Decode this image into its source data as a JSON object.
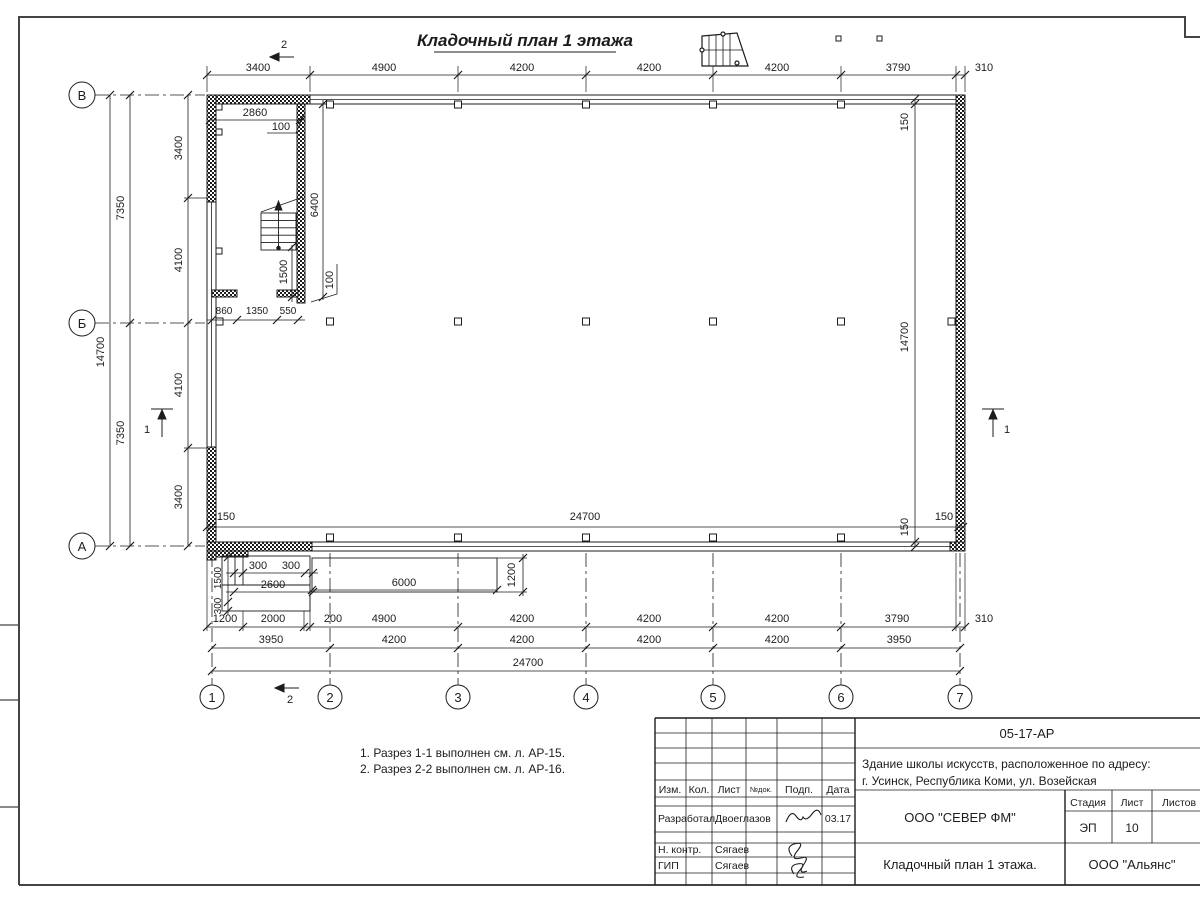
{
  "page_title": "Кладочный план 1 этажа",
  "plan": {
    "axis_letters": [
      "В",
      "Б",
      "А"
    ],
    "axis_numbers": [
      "1",
      "2",
      "3",
      "4",
      "5",
      "6",
      "7"
    ],
    "sections": {
      "one": "1",
      "two": "2"
    },
    "dims": {
      "top": [
        "3400",
        "4900",
        "4200",
        "4200",
        "4200",
        "3790",
        "310"
      ],
      "left_outer": "14700",
      "left_mid": [
        "7350",
        "7350"
      ],
      "left_inner": [
        "3400",
        "4100",
        "4100",
        "3400"
      ],
      "right_side": [
        "150",
        "14700",
        "150"
      ],
      "inner_bottom": [
        "150",
        "24700",
        "150"
      ],
      "stair": {
        "width": "2860",
        "gap_top": "100",
        "depth": "6400",
        "landing": "1500",
        "gap_bottom": "100",
        "bottom_row": [
          "860",
          "1350",
          "550"
        ]
      },
      "porch": {
        "step_a": "300",
        "step_b": "300",
        "width": "2600",
        "height": "1500",
        "step_v": "300",
        "ramp_length": "6000",
        "ramp_width": "1200"
      },
      "row1": [
        "1200",
        "2000",
        "200",
        "4900",
        "4200",
        "4200",
        "4200",
        "3790",
        "310"
      ],
      "row2": [
        "3950",
        "4200",
        "4200",
        "4200",
        "4200",
        "3950"
      ],
      "row3": "24700"
    }
  },
  "notes": [
    "1. Разрез 1-1 выполнен см. л. АР-15.",
    "2. Разрез 2-2 выполнен см. л. АР-16."
  ],
  "title_block": {
    "doc_number": "05-17-АР",
    "project_line1": "Здание школы искусств, расположенное по адресу:",
    "project_line2": "г. Усинск, Республика Коми, ул. Возейская",
    "cols": {
      "izm": "Изм.",
      "kol": "Кол.",
      "list": "Лист",
      "ndok": "№док.",
      "podp": "Подп.",
      "data": "Дата"
    },
    "rows": [
      {
        "role": "Разработал",
        "name": "Двоеглазов",
        "date": "03.17"
      },
      {
        "role": "Н. контр.",
        "name": "Сягаев",
        "date": ""
      },
      {
        "role": "ГИП",
        "name": "Сягаев",
        "date": ""
      }
    ],
    "org": "ООО \"СЕВЕР ФМ\"",
    "stage_label": "Стадия",
    "stage": "ЭП",
    "sheet_label": "Лист",
    "sheet_no": "10",
    "sheets_label": "Листов",
    "sheet_title": "Кладочный план 1 этажа.",
    "org2": "ООО \"Альянс\""
  }
}
